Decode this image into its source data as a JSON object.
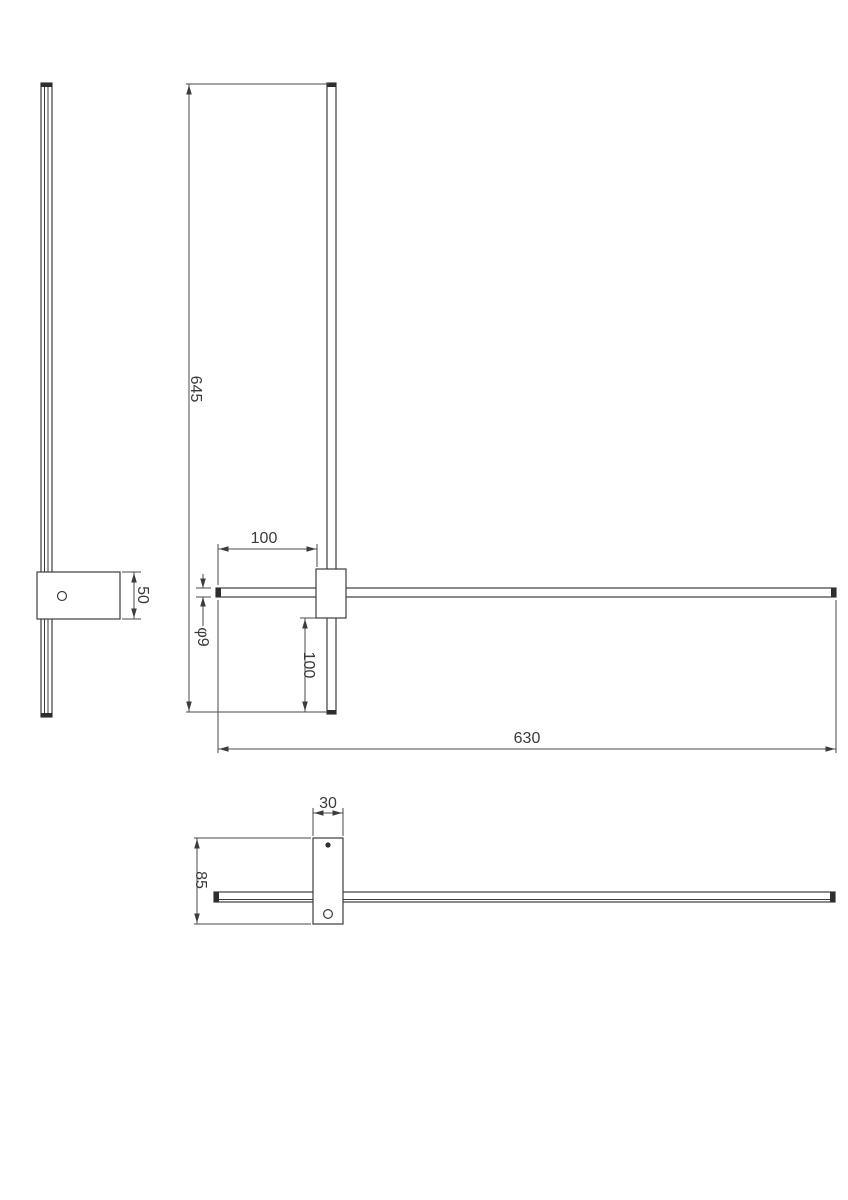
{
  "drawing": {
    "labels": {
      "side_bracket_height": "50",
      "front_height": "645",
      "front_tube_left_offset": "100",
      "tube_diameter": "φ9",
      "rod_bottom_extension": "100",
      "tube_length": "630",
      "top_bracket_width": "30",
      "top_bracket_depth": "85"
    },
    "colors": {
      "background": "#ffffff",
      "outline": "#3c3c3c",
      "dimension_lines": "#4a4a4a",
      "text": "#3a3a3a"
    }
  }
}
